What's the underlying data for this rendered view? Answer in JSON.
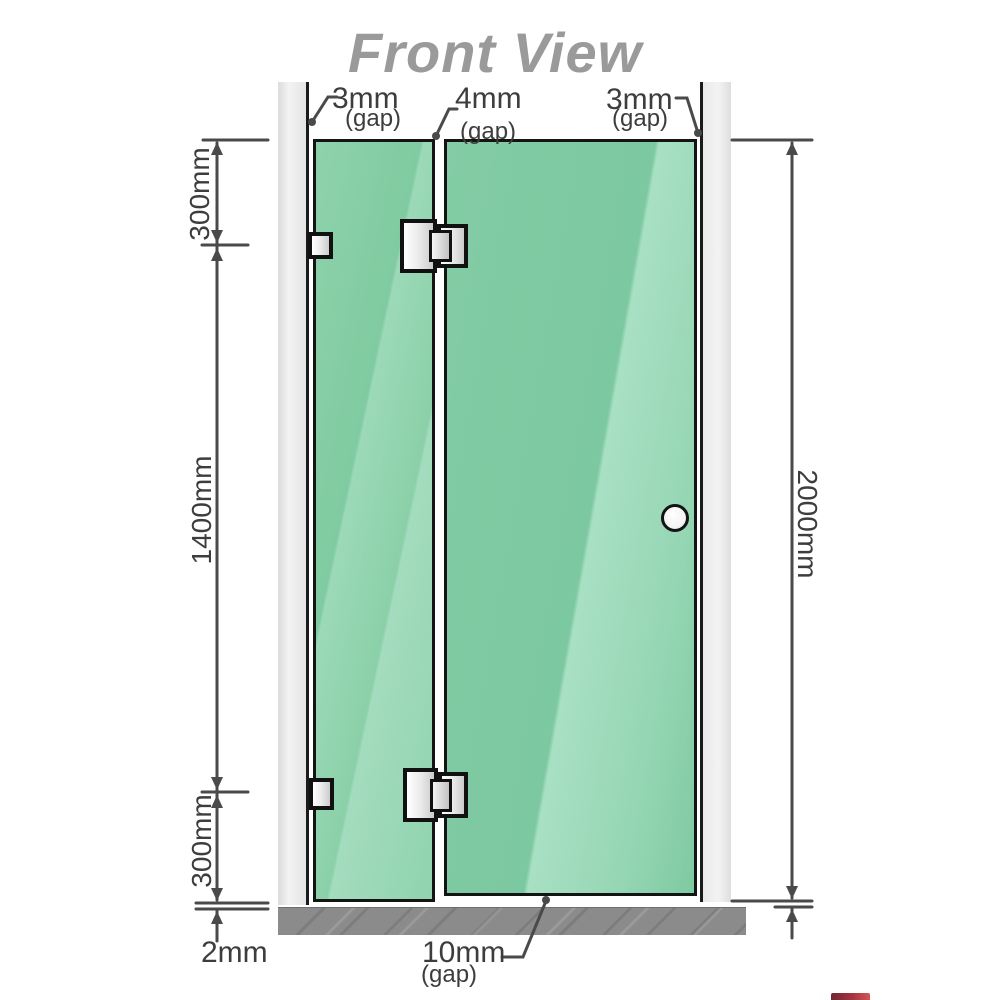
{
  "title": "Front View",
  "dimensions": {
    "gap_top_left": {
      "value": "3mm",
      "note": "(gap)"
    },
    "gap_top_middle": {
      "value": "4mm",
      "note": "(gap)"
    },
    "gap_top_right": {
      "value": "3mm",
      "note": "(gap)"
    },
    "height_top_segment": "300mm",
    "height_middle_segment": "1400mm",
    "height_bottom_segment": "300mm",
    "floor_clearance": "2mm",
    "total_height": "2000mm",
    "gap_bottom": {
      "value": "10mm",
      "note": "(gap)"
    }
  },
  "colors": {
    "glass_green": "#7ec9a1",
    "wall_channel_gray": "#e8e8e8",
    "floor_gray": "#8b8b8b",
    "dimension_line": "#4a4a4a",
    "title_gray": "#9a9a9a",
    "outline_black": "#141414",
    "logo_red": "#8e1b26"
  },
  "icons": {
    "door_handle": "round-knob",
    "hinges": "glass-to-glass-hinge",
    "brackets": "wall-mount-bracket"
  }
}
